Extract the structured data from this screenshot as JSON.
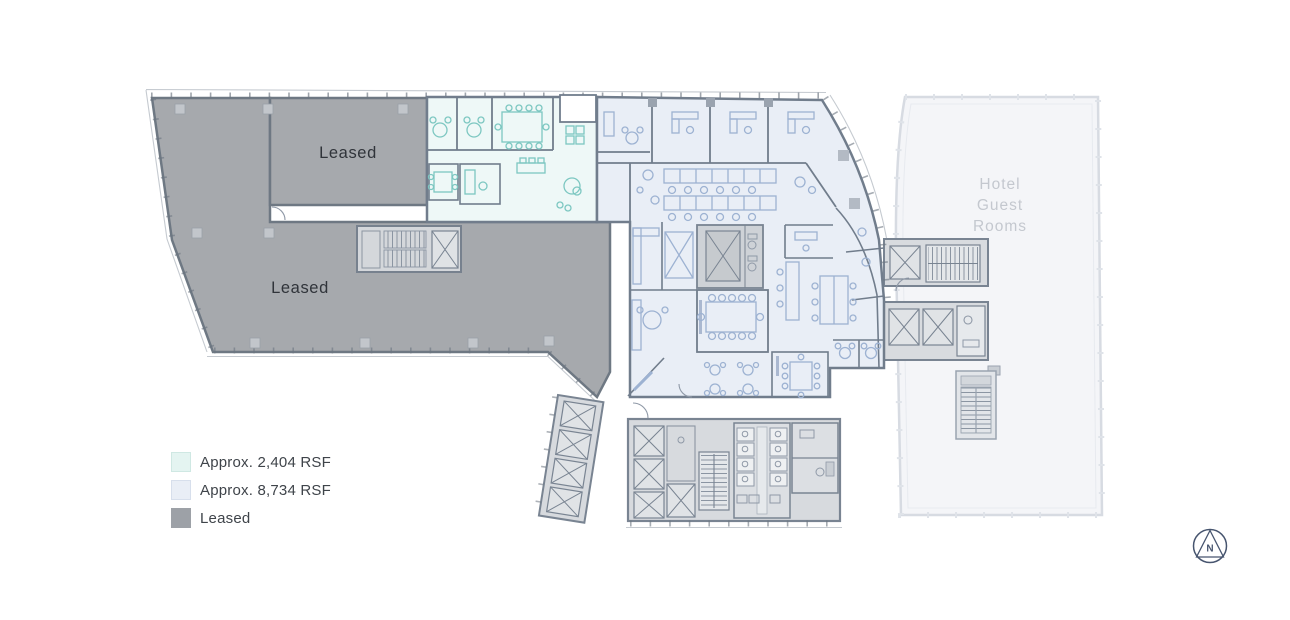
{
  "plan": {
    "leased_label_upper": "Leased",
    "leased_label_lower": "Leased",
    "hotel_label": {
      "line1": "Hotel",
      "line2": "Guest",
      "line3": "Rooms"
    }
  },
  "legend": {
    "items": [
      {
        "label": "Approx. 2,404 RSF",
        "swatch_color": "#e4f4f1"
      },
      {
        "label": "Approx. 8,734 RSF",
        "swatch_color": "#e9eef6"
      },
      {
        "label": "Leased",
        "swatch_color": "#9da1a7"
      }
    ]
  },
  "compass": {
    "label": "N"
  },
  "colors": {
    "leased_fill": "#a6a9ad",
    "suite_2404_fill": "#eef8f7",
    "suite_2404_line": "#7cc7c1",
    "suite_8734_fill": "#e9eef6",
    "suite_8734_line": "#9db2d2",
    "core_fill": "#d7dade",
    "hotel_fill": "#f4f5f8",
    "wall": "#717d8c",
    "compass_color": "#47556f"
  }
}
